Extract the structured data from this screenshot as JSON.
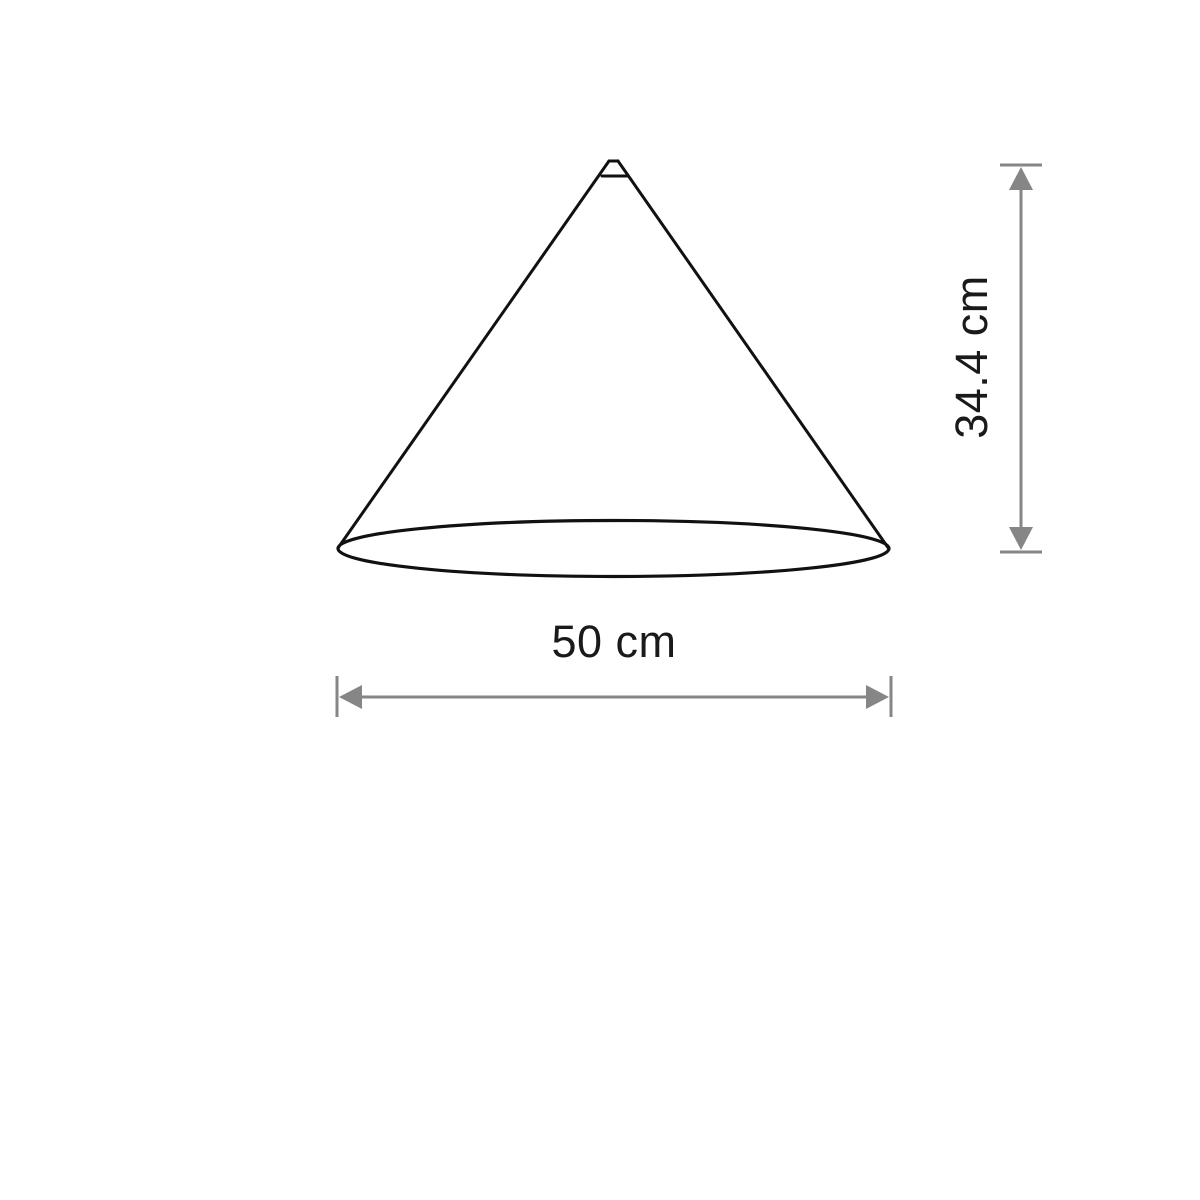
{
  "drawing": {
    "width_dimension": {
      "label": "50 cm"
    },
    "height_dimension": {
      "label": "34.4 cm"
    },
    "colors": {
      "outline": "#111111",
      "dimension_lines": "#868686",
      "label_text": "#1a1a1a",
      "background": "#ffffff"
    }
  }
}
